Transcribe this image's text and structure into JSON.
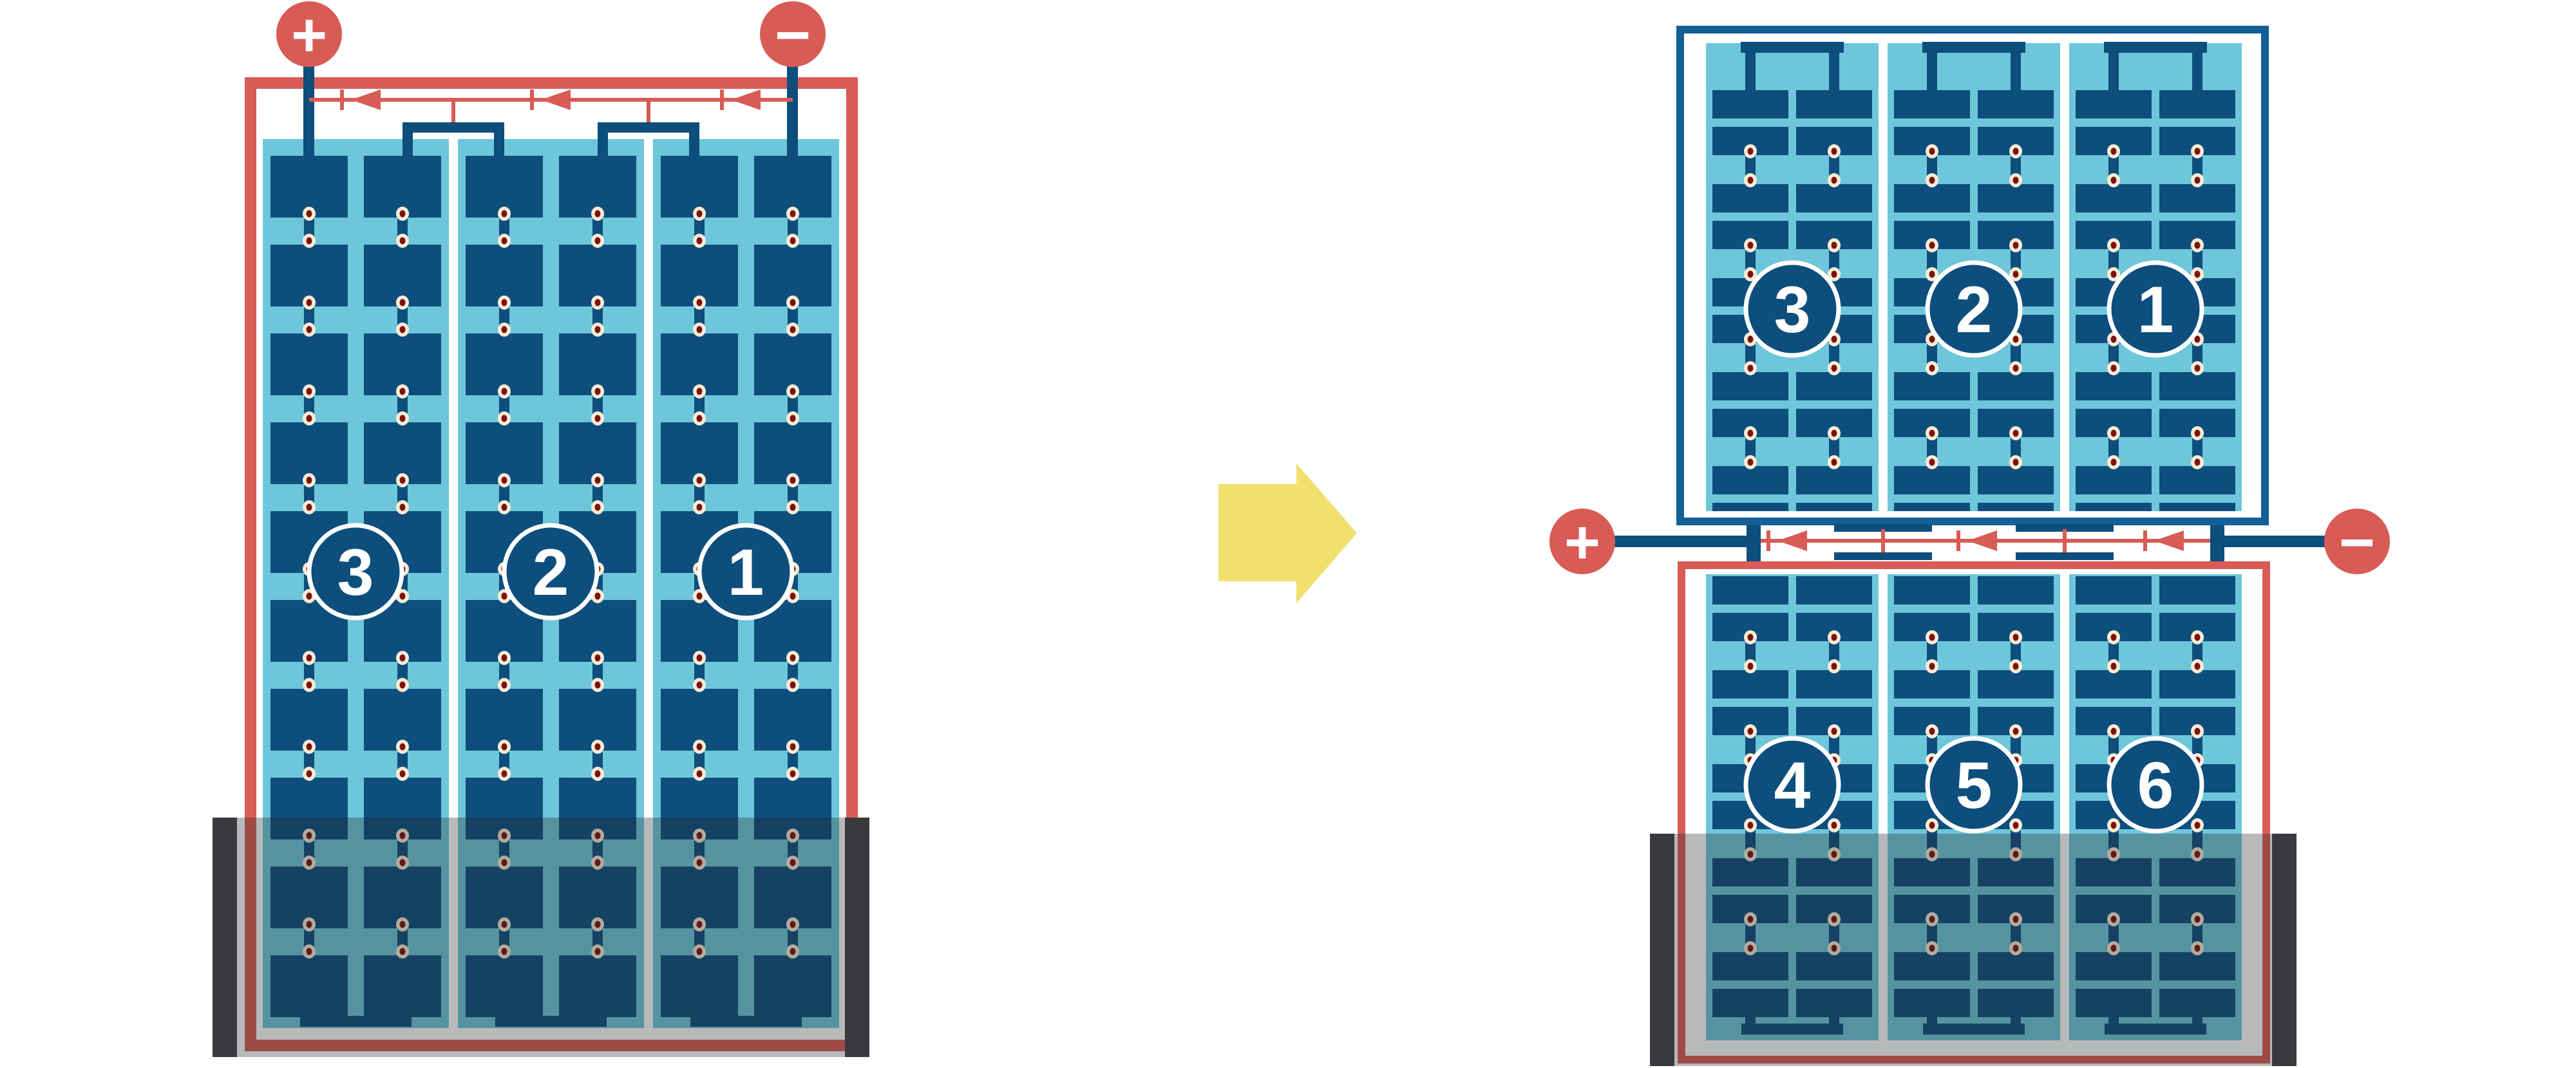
{
  "diagram": {
    "description_semantic": "solar-panel-string-reconfiguration-before-after",
    "before_panel": {
      "terminal_positive": "+",
      "terminal_negative": "−",
      "string_labels": [
        "3",
        "2",
        "1"
      ]
    },
    "after_panels": {
      "terminal_positive": "+",
      "terminal_negative": "−",
      "top_string_labels": [
        "3",
        "2",
        "1"
      ],
      "bottom_string_labels": [
        "4",
        "5",
        "6"
      ]
    }
  },
  "colors": {
    "red": "#D85B55",
    "cell_blue": "#0D4E7D",
    "frame_blue": "#135F98",
    "light_blue": "#6EC6DA",
    "cream": "#F6ECD4",
    "dot_red": "#7D1112",
    "yellow": "#F2E06E",
    "white": "#FFFFFF",
    "overlay": "rgba(40,42,46,0.33)",
    "shade_bar": "#3A3A3E"
  }
}
